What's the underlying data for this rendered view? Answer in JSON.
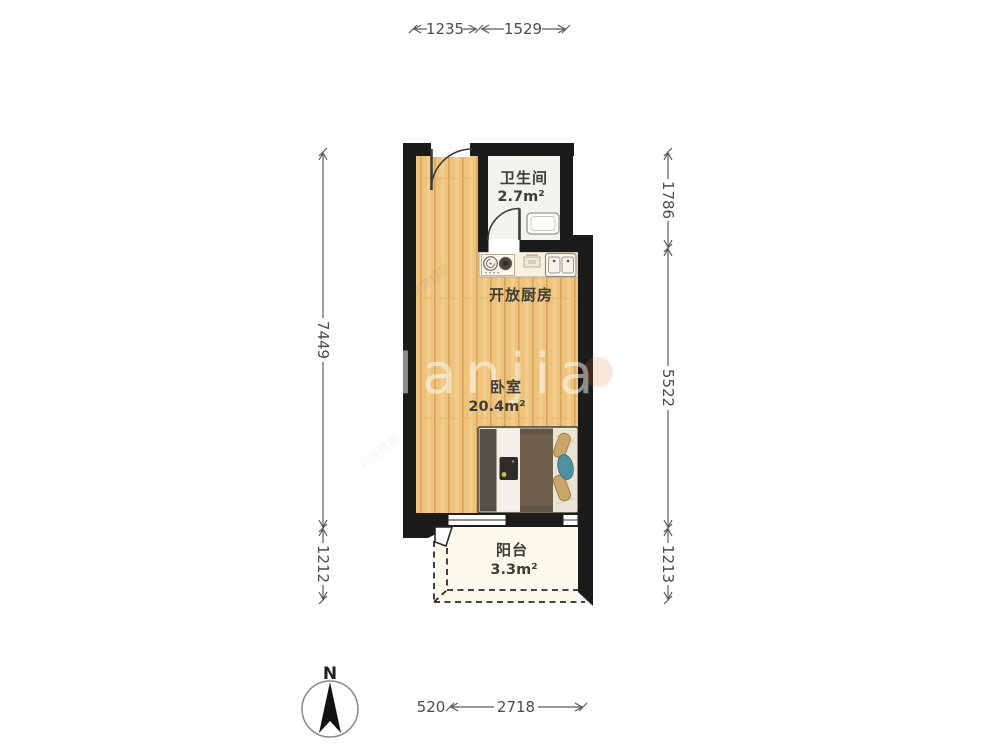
{
  "floorplan": {
    "rooms": {
      "bathroom": {
        "name": "卫生间",
        "area": "2.7m²"
      },
      "kitchen": {
        "name": "开放厨房"
      },
      "bedroom": {
        "name": "卧室",
        "area": "20.4m²"
      },
      "balcony": {
        "name": "阳台",
        "area": "3.3m²"
      }
    },
    "dimensions": {
      "top_left": "1235",
      "top_right": "1529",
      "left_upper": "7449",
      "left_lower": "1212",
      "right_upper": "1786",
      "right_middle": "5522",
      "right_lower": "1213",
      "bottom_offset": "520",
      "bottom_main": "2718"
    },
    "compass": {
      "north_label": "N"
    },
    "watermark": {
      "brand": "lanjia",
      "small": "贝壳找房"
    },
    "colors": {
      "wall": "#1b1b1b",
      "wood_floor": "#edc37e",
      "bathroom_floor": "#f2f2ef",
      "balcony_floor": "#fbfaec",
      "counter": "#f7f2df",
      "dimension_text": "#4c4c4c"
    }
  }
}
